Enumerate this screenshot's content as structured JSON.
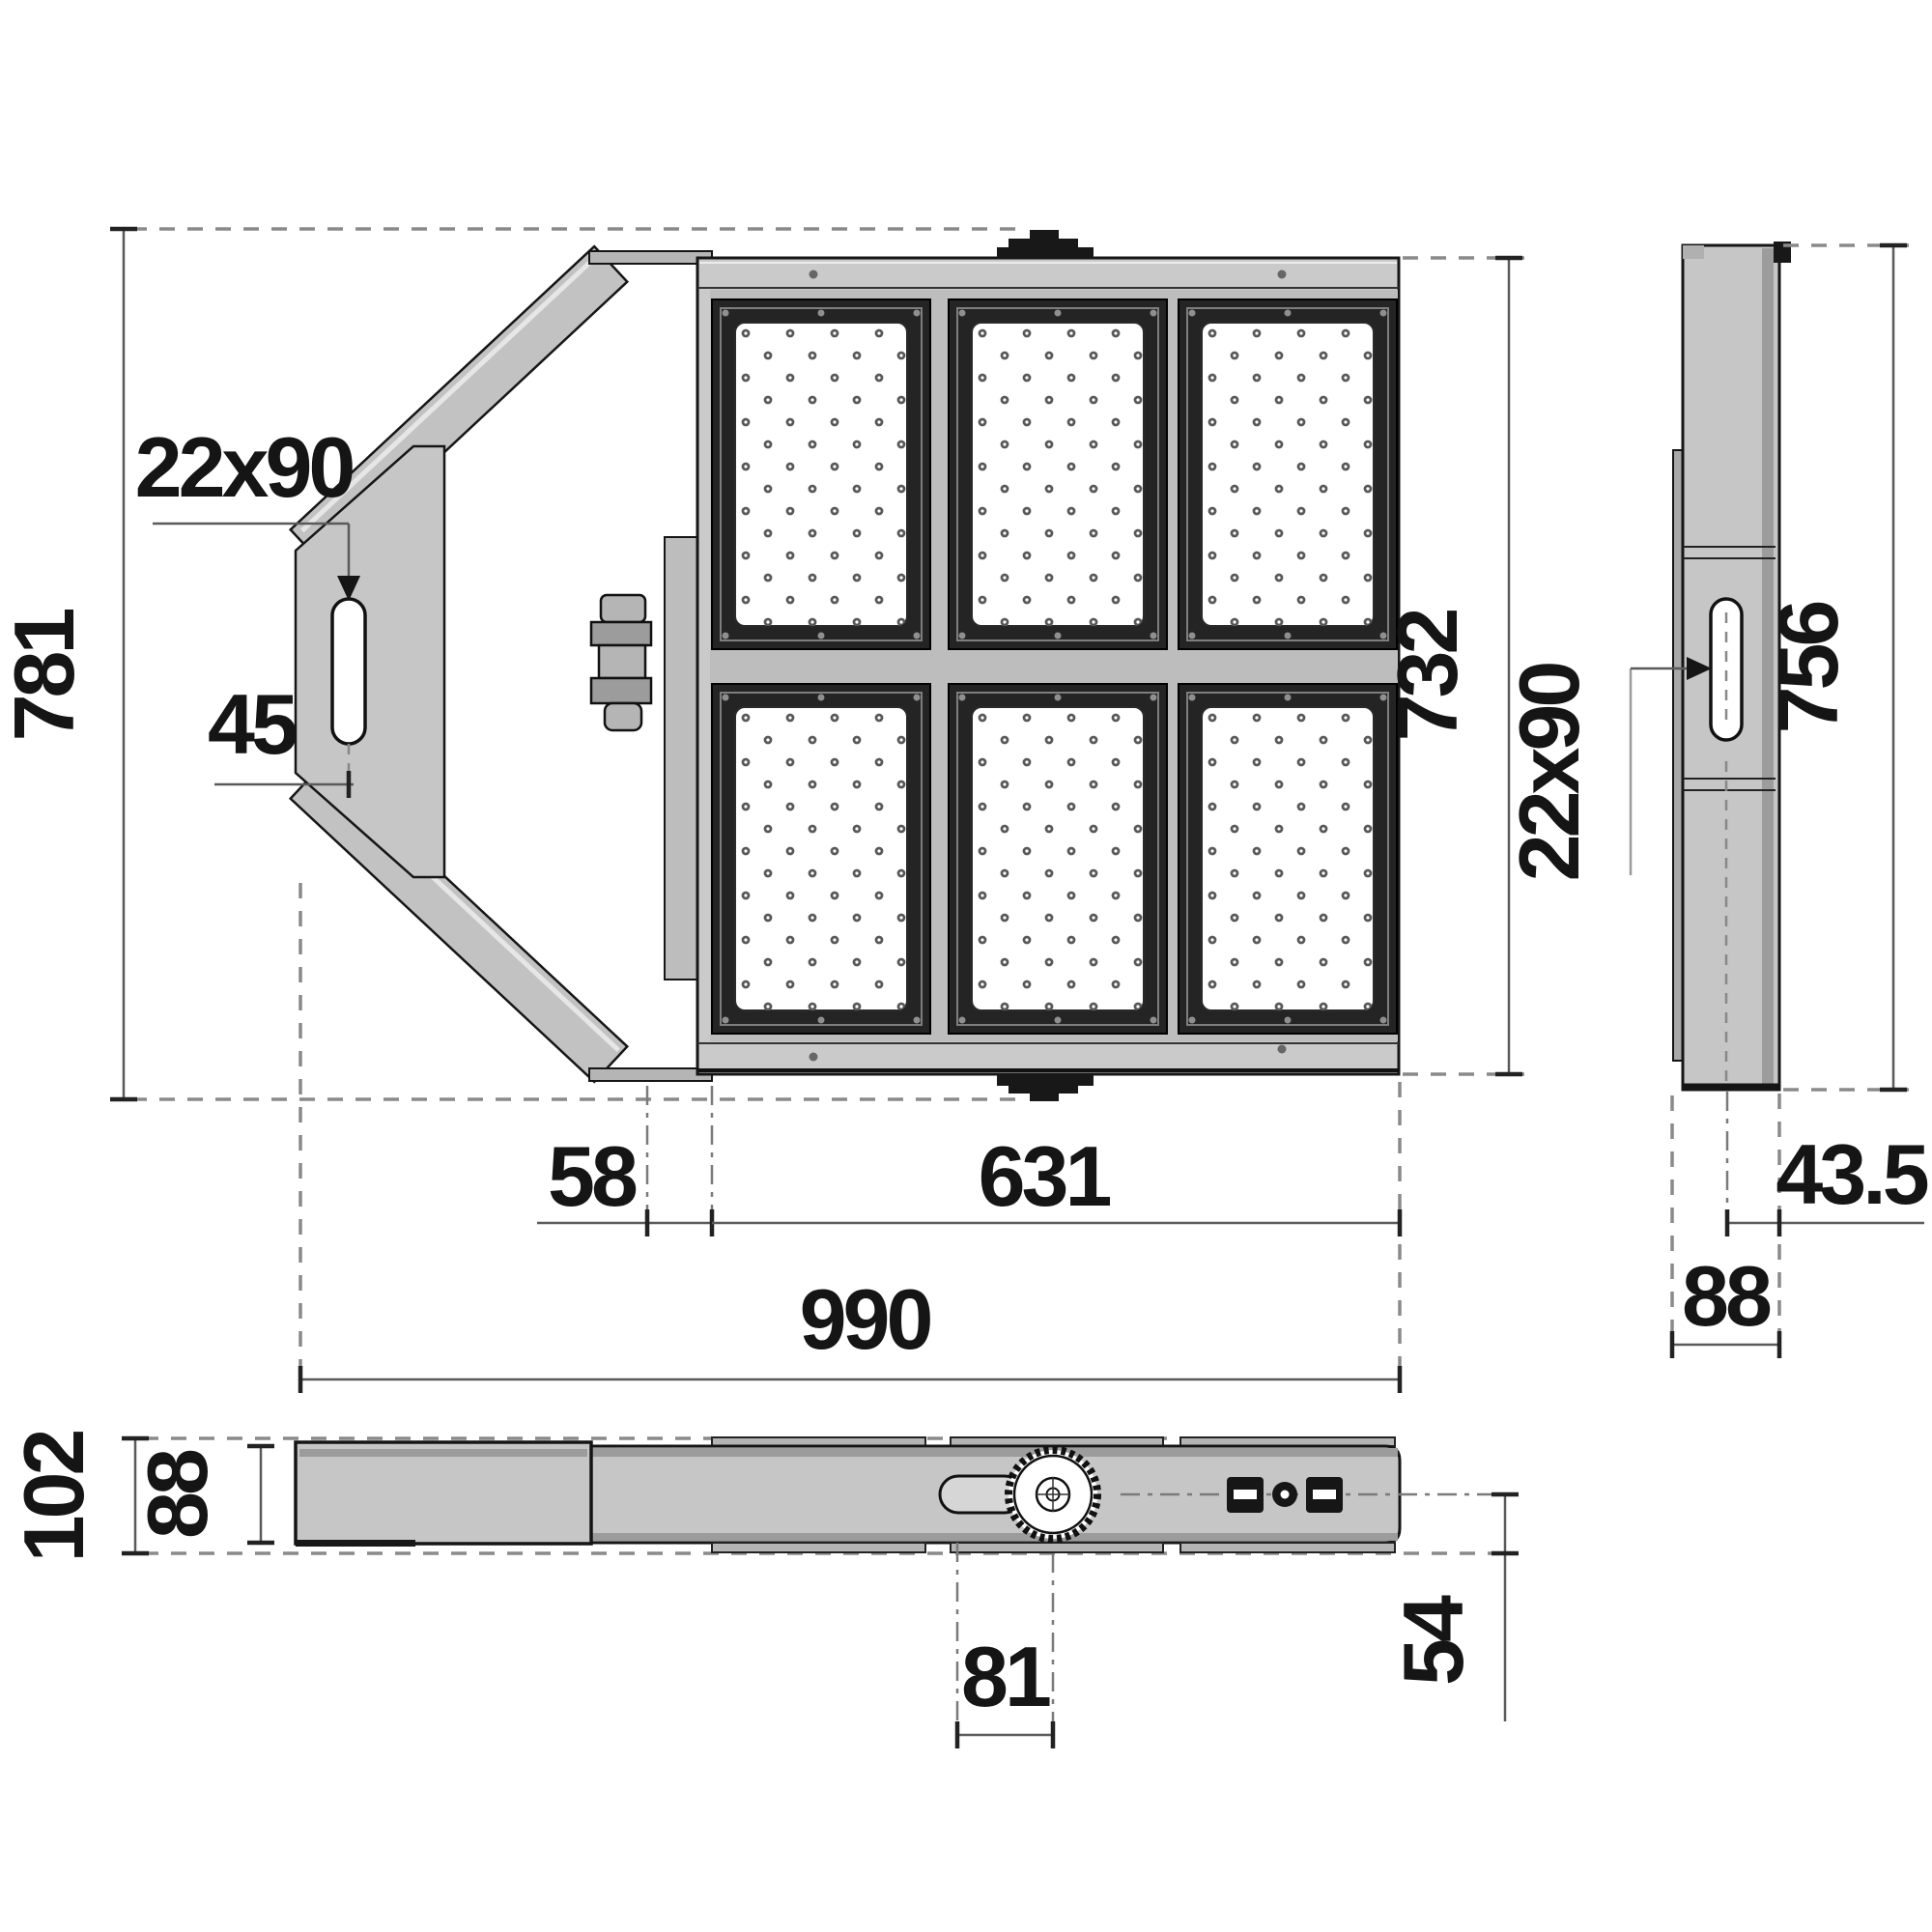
{
  "drawing": {
    "type": "dimensional technical drawing of LED floodlight (3 views)",
    "colors": {
      "housing_gray": "#c6c6c6",
      "shade_gray": "#9c9c9c",
      "frame_black": "#242424",
      "panel_white": "#ffffff",
      "dim_line": "#5a5a5a",
      "dashed_line": "#8a8a8a",
      "text": "#151515"
    },
    "views": {
      "front": {
        "dims": {
          "overall_height": "781",
          "bracket_slot": "22x90",
          "slot_offset": "45",
          "housing_height": "732",
          "left_inset": "58",
          "module_width": "631",
          "overall_width": "990"
        }
      },
      "side": {
        "dims": {
          "bracket_slot": "22x90",
          "housing_height": "756",
          "center_to_face": "43.5",
          "housing_depth": "88"
        }
      },
      "bottom": {
        "dims": {
          "overall_depth": "102",
          "housing_depth": "88",
          "pivot_offset": "81",
          "center_to_underside": "54"
        }
      }
    }
  }
}
